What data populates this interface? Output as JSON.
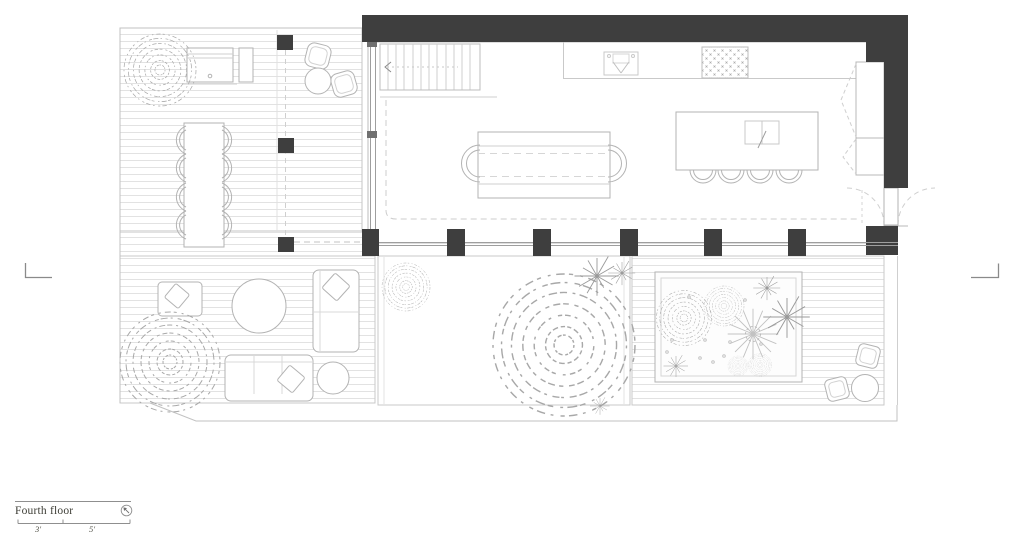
{
  "title_block": {
    "floor_label": "Fourth floor",
    "scale_bar": {
      "segment_1_label": "3'",
      "segment_2_label": "5'"
    }
  },
  "icons": {
    "north_arrow": "north-arrow-icon"
  },
  "colors": {
    "background": "#ffffff",
    "wall_fill": "#3e3e3e",
    "deck_line": "#e0e0e0",
    "outline_light": "#c6c6c6",
    "furniture_line": "#b3b3b3",
    "glass_line": "#9e9e9e",
    "vegetation_line": "#a8a8a8",
    "text": "#3c3c34"
  }
}
